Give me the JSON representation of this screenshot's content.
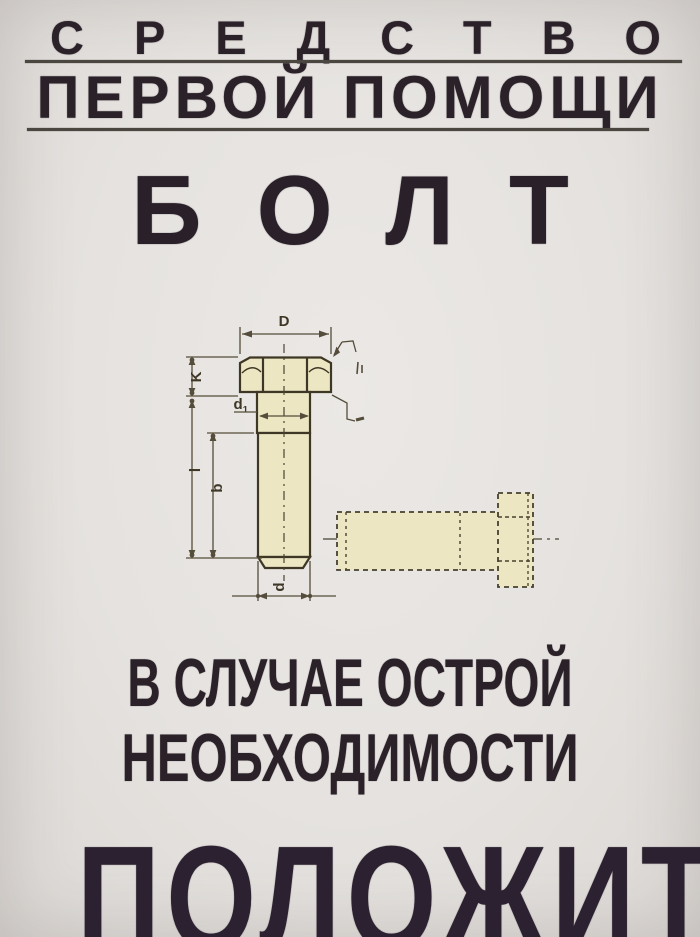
{
  "poster": {
    "colors": {
      "background": "#e5e2df",
      "ink": "#2b2129",
      "underline": "#4c4640",
      "bolt_fill": "#ece7c2",
      "drawing_line": "#3e3726"
    },
    "header": {
      "line1": "СРЕДСТВО",
      "line2": "ПЕРВОЙ ПОМОЩИ"
    },
    "title": "БОЛТ",
    "diagram_labels": {
      "head_width": "D",
      "head_height": "K",
      "neck_diameter_base": "d",
      "neck_diameter_sub": "1",
      "length": "l",
      "thread_length": "b",
      "shank_diameter": "d"
    },
    "footer": {
      "line1": "В СЛУЧАЕ ОСТРОЙ",
      "line2": "НЕОБХОДИМОСТИ",
      "action": "ПОЛОЖИТЬ"
    }
  }
}
